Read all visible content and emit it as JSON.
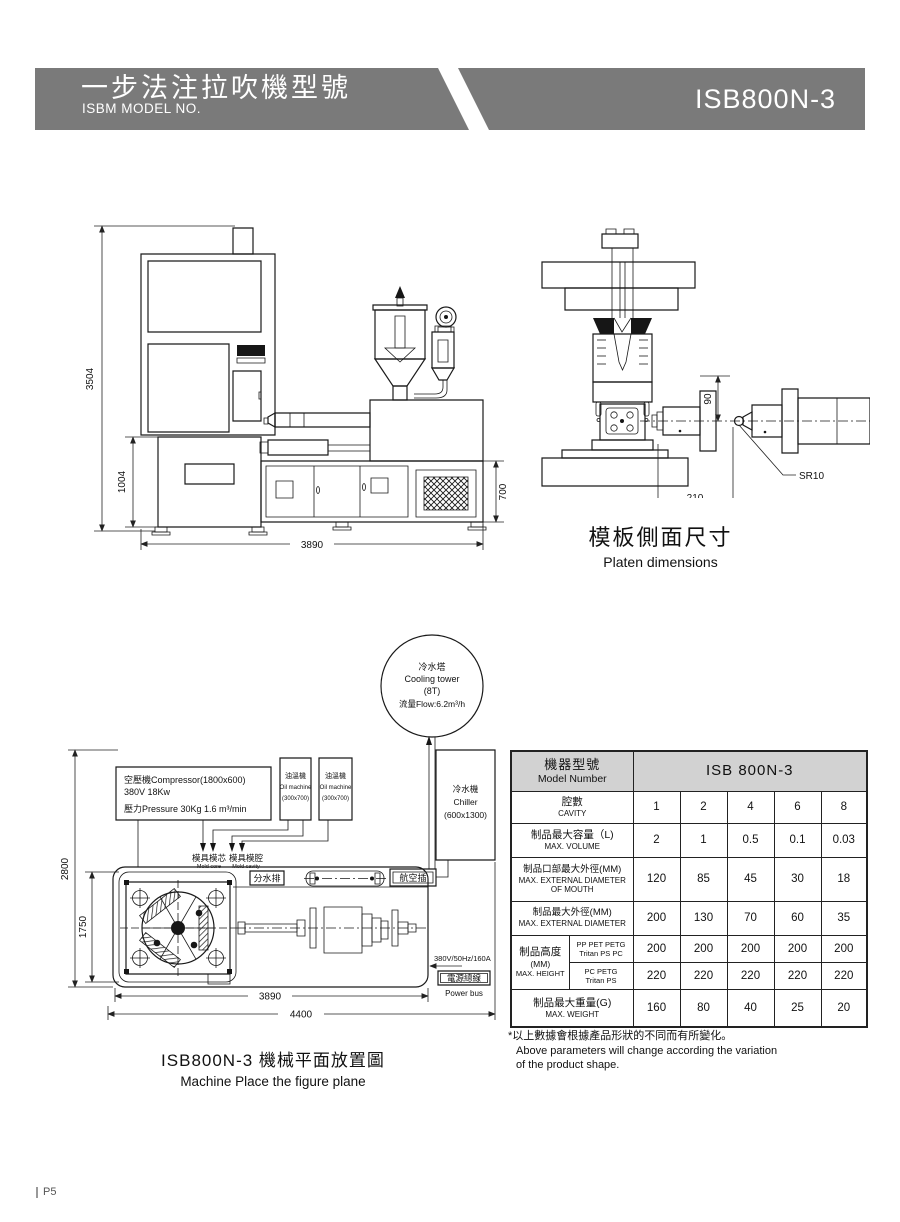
{
  "colors": {
    "banner_gray": "#7a7a7a",
    "table_header_bg": "#d2d2d2",
    "line": "#1a1a1a"
  },
  "header": {
    "title_zh": "一步法注拉吹機型號",
    "title_en": "ISBM MODEL NO.",
    "model": "ISB800N-3"
  },
  "front_view": {
    "dim_total_height": "3504",
    "dim_clamp_height": "1004",
    "dim_total_width": "3890",
    "dim_base_height": "700"
  },
  "platen_view": {
    "dim_vertical": "90",
    "dim_horizontal": "210",
    "dim_radius": "SR10",
    "caption_zh": "模板側面尺寸",
    "caption_en": "Platen dimensions"
  },
  "layout_view": {
    "cooling_tower": {
      "zh": "冷水塔",
      "en": "Cooling tower",
      "capacity": "(8T)",
      "flow": "流量Flow:6.2m³/h"
    },
    "compressor": {
      "line1": "空壓機Compressor(1800x600)",
      "line2": "380V  18Kw",
      "line3": "壓力Pressure 30Kg  1.6 m³/min"
    },
    "oil_machine": {
      "zh": "油溫機",
      "en": "Oil machine",
      "size": "(300x700)"
    },
    "chiller": {
      "zh": "冷水機",
      "en": "Chiller",
      "size": "(600x1300)"
    },
    "mold_core_zh": "模具模芯",
    "mold_core_en": "Mold core",
    "mold_cavity_zh": "模具模腔",
    "mold_cavity_en": "Mold cavity",
    "water_manifold": "分水排",
    "aviation_plug": "航空插",
    "power_spec": "380V/50Hz/160A",
    "power_bus_zh": "電源總線",
    "power_bus_en": "Power bus",
    "dims": {
      "d2800": "2800",
      "d1750": "1750",
      "d3890": "3890",
      "d4400": "4400"
    },
    "caption_zh": "ISB800N-3  機械平面放置圖",
    "caption_en": "Machine Place the figure plane"
  },
  "spec_table": {
    "model_label_zh": "機器型號",
    "model_label_en": "Model Number",
    "model_value": "ISB 800N-3",
    "rows": [
      {
        "zh": "腔數",
        "en": "CAVITY",
        "values": [
          "1",
          "2",
          "4",
          "6",
          "8"
        ]
      },
      {
        "zh": "制品最大容量（L)",
        "en": "MAX. VOLUME",
        "values": [
          "2",
          "1",
          "0.5",
          "0.1",
          "0.03"
        ]
      },
      {
        "zh": "制品口部最大外徑(MM)",
        "en": "MAX. EXTERNAL DIAMETER OF MOUTH",
        "values": [
          "120",
          "85",
          "45",
          "30",
          "18"
        ]
      },
      {
        "zh": "制品最大外徑(MM)",
        "en": "MAX. EXTERNAL DIAMETER",
        "values": [
          "200",
          "130",
          "70",
          "60",
          "35"
        ]
      }
    ],
    "height": {
      "zh": "制品高度",
      "unit": "(MM)",
      "en": "MAX. HEIGHT",
      "sub_rows": [
        {
          "material_line1": "PP PET PETG",
          "material_line2": "Tritan PS PC",
          "values": [
            "200",
            "200",
            "200",
            "200",
            "200"
          ]
        },
        {
          "material_line1": "PC  PETG",
          "material_line2": "Tritan PS",
          "values": [
            "220",
            "220",
            "220",
            "220",
            "220"
          ]
        }
      ]
    },
    "weight": {
      "zh": "制品最大重量(G)",
      "en": "MAX. WEIGHT",
      "values": [
        "160",
        "80",
        "40",
        "25",
        "20"
      ]
    }
  },
  "footnote": {
    "line1_zh": "*以上數據會根據產品形狀的不同而有所變化。",
    "line2_en": "Above parameters will change according the variation",
    "line3_en": "of the product shape."
  },
  "page": {
    "number": "P5"
  }
}
